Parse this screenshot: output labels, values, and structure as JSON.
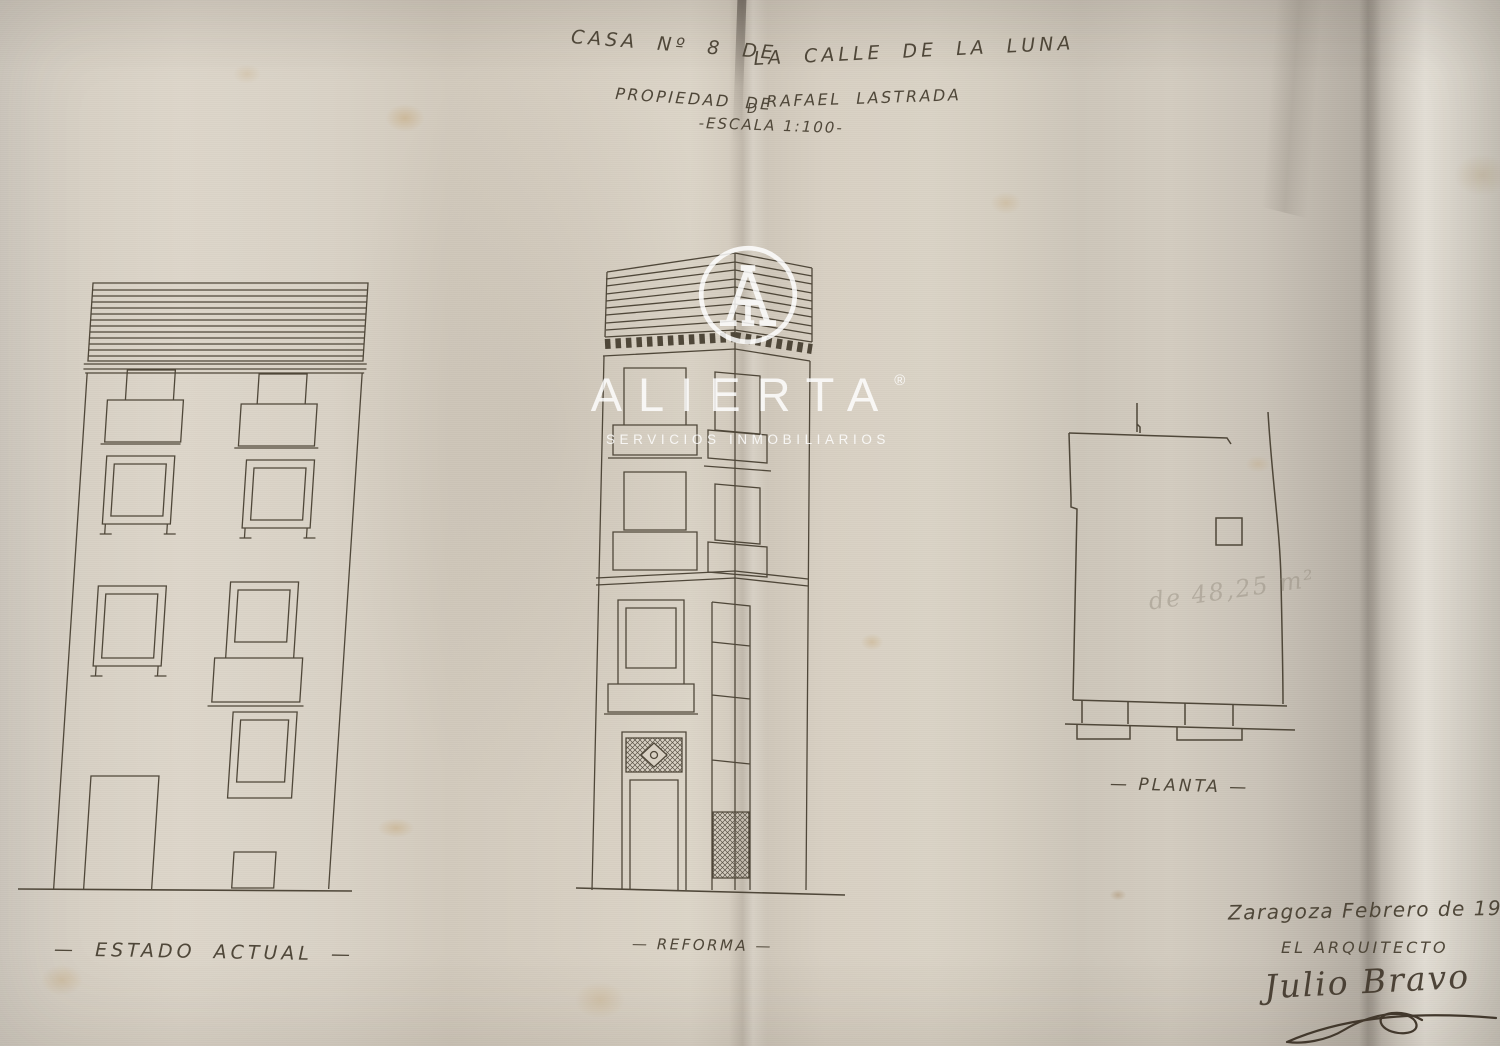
{
  "title": {
    "line1_left": "CASA Nº 8 DE",
    "line1_right": "LA CALLE DE LA LUNA",
    "line2_left": "PROPIEDAD DE",
    "line2_mid": "D",
    "line2_right": "RAFAEL LASTRADA",
    "line3": "-ESCALA 1:100-"
  },
  "drawings": {
    "estado_actual": {
      "label": "— ESTADO ACTUAL —"
    },
    "reforma": {
      "label": "— REFORMA —"
    },
    "planta": {
      "label": "— PLANTA —",
      "area_note": "de 48,25 m²"
    }
  },
  "signature_block": {
    "place_date": "Zaragoza Febrero de 1915",
    "role": "EL ARQUITECTO",
    "signature_name": "Julio Bravo"
  },
  "watermark": {
    "brand": "ALIERTA",
    "registered": "®",
    "tagline": "SERVICIOS INMOBILIARIOS",
    "logo_letter": "A",
    "color": "#ffffff"
  },
  "colors": {
    "paper": "#d6cfc3",
    "ink": "#4f4739",
    "pencil": "#8d8577",
    "signature": "#42382c",
    "watermark": "#ffffff"
  }
}
